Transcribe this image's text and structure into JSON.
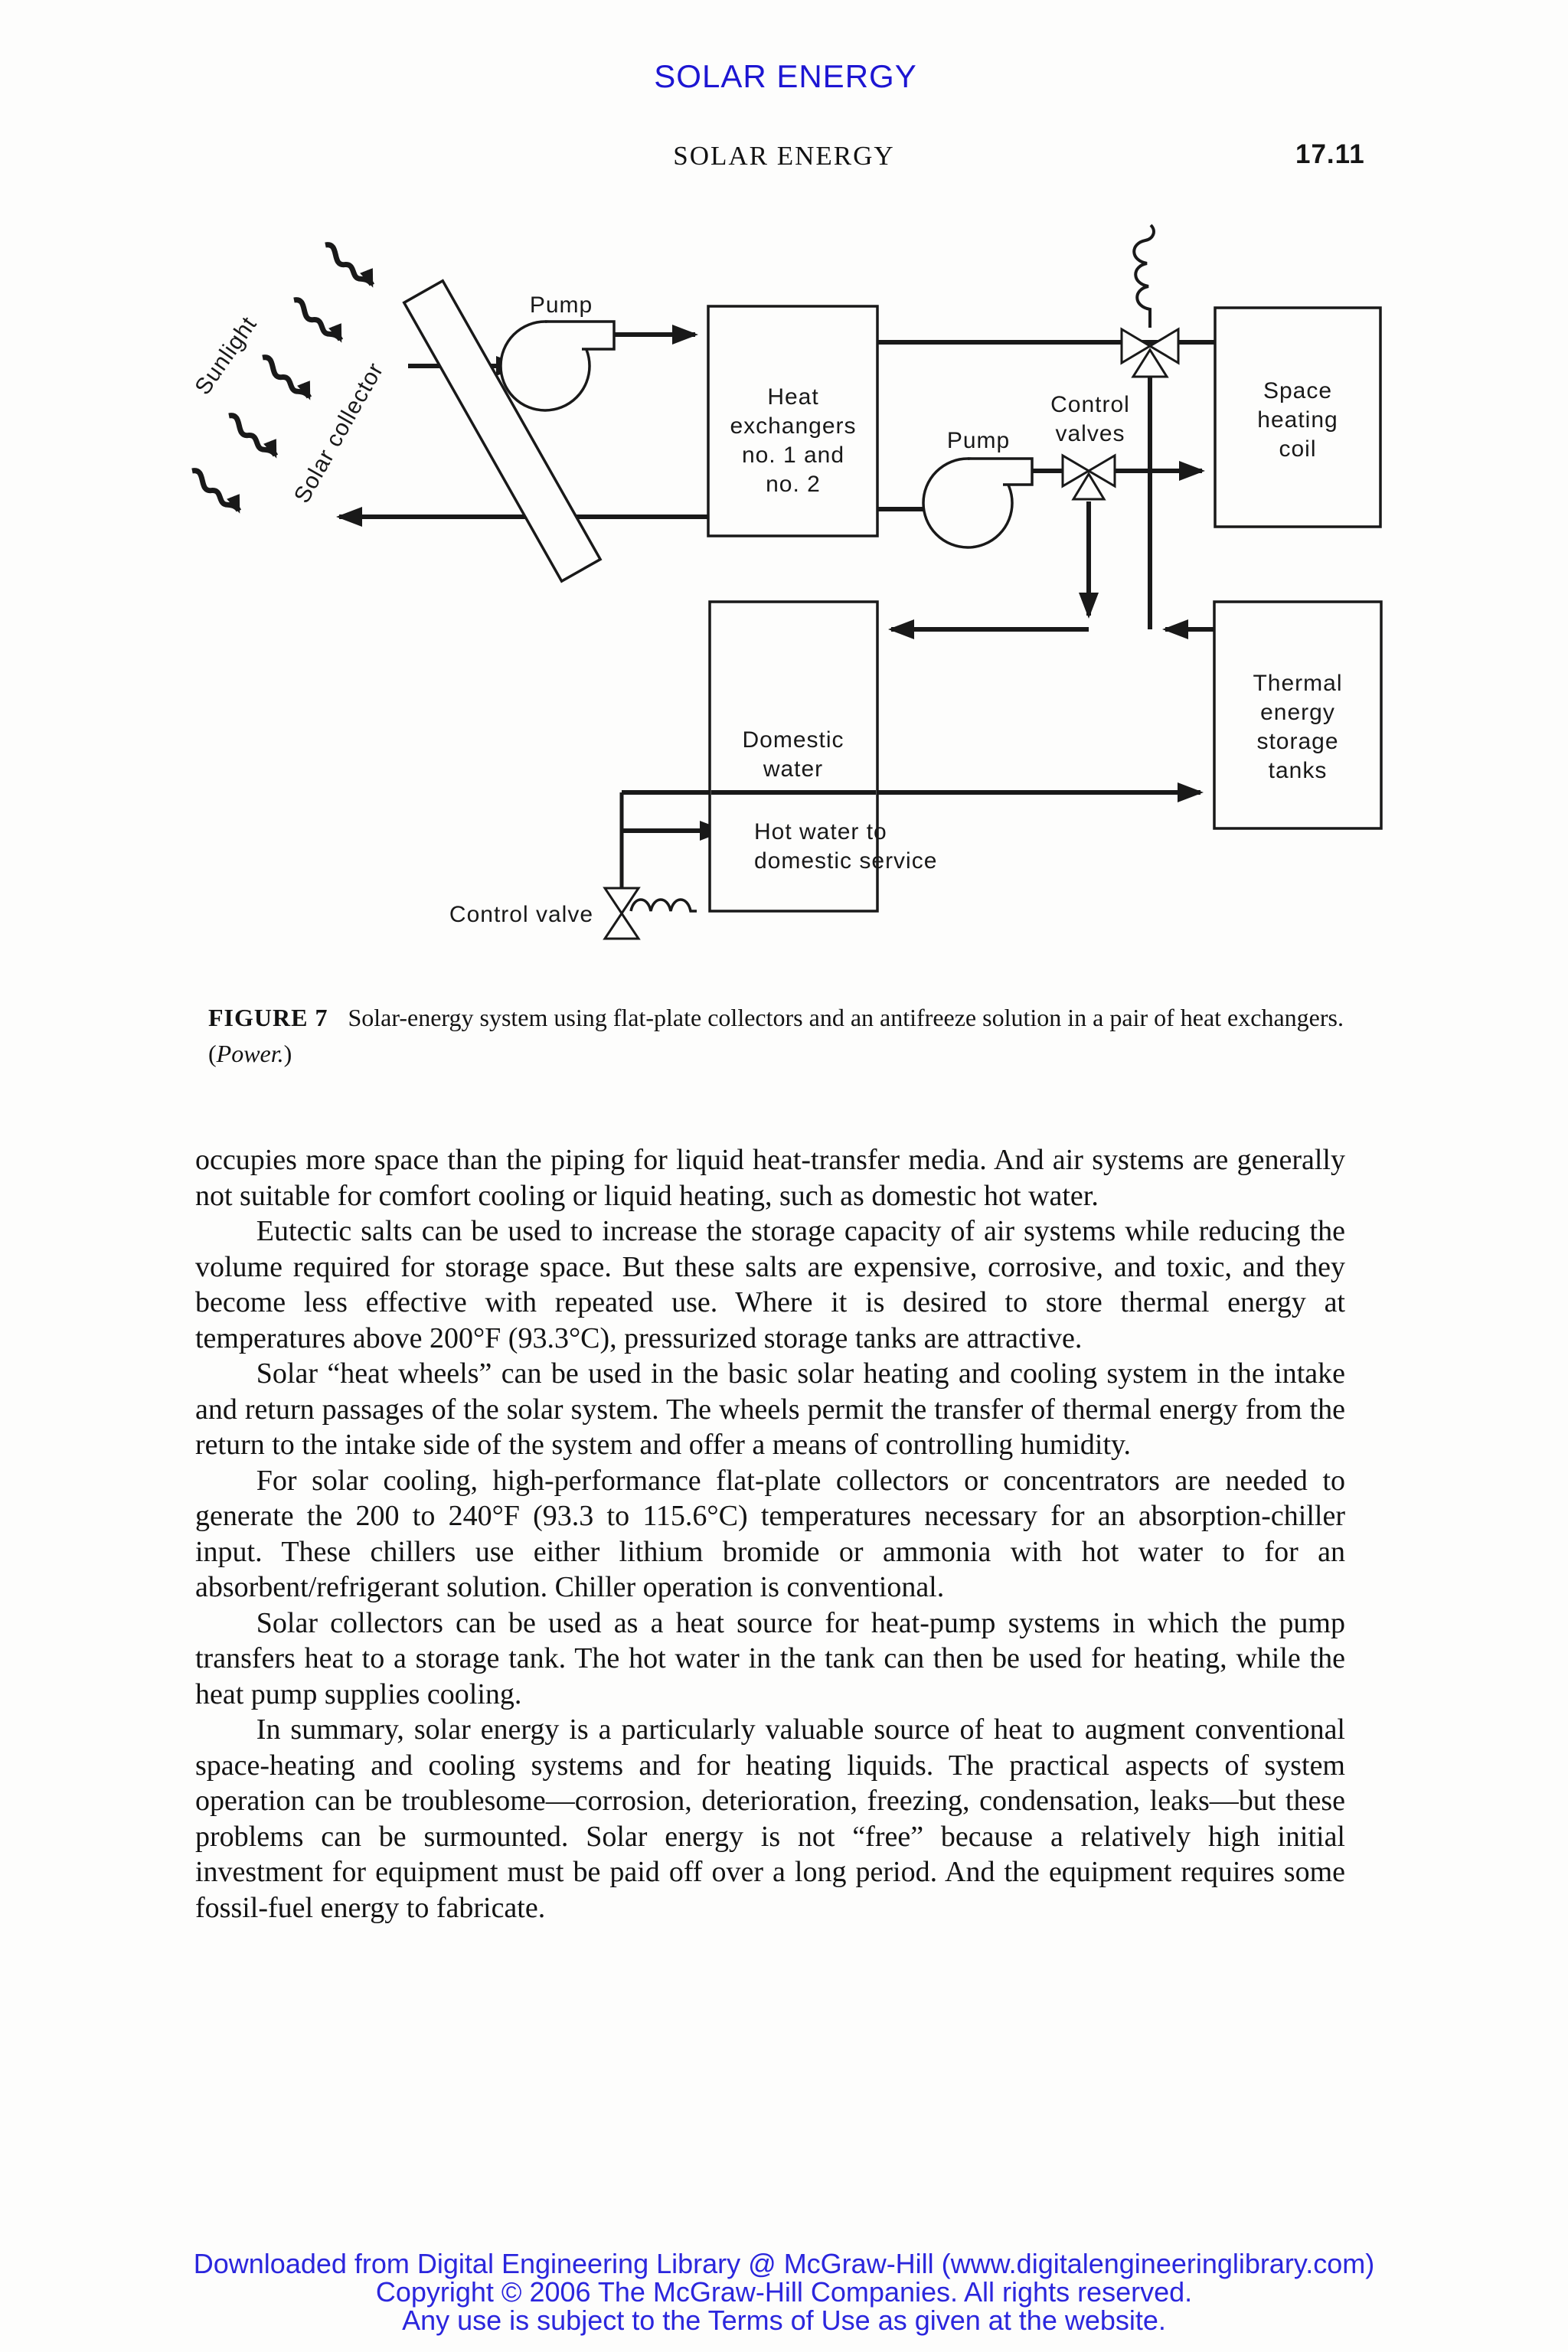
{
  "page": {
    "banner": "SOLAR ENERGY",
    "running_head": "SOLAR ENERGY",
    "page_number": "17.11",
    "colors": {
      "header_blue": "#1d16d2",
      "footer_blue": "#2b26dd",
      "ink": "#151515"
    },
    "figure": {
      "labels": {
        "sunlight": "Sunlight",
        "solar_collector": "Solar collector",
        "pump_top": "Pump",
        "pump_middle": "Pump",
        "control_valves_line1": "Control",
        "control_valves_line2": "valves",
        "heat_exchangers": [
          "Heat",
          "exchangers",
          "no. 1 and",
          "no. 2"
        ],
        "space_heating_coil": [
          "Space",
          "heating",
          "coil"
        ],
        "domestic_water": [
          "Domestic",
          "water"
        ],
        "thermal_storage": [
          "Thermal",
          "energy",
          "storage",
          "tanks"
        ],
        "hot_water_line1": "Hot water to",
        "hot_water_line2": "domestic service",
        "control_valve": "Control valve"
      },
      "caption": {
        "label": "FIGURE 7",
        "text": "Solar-energy system using flat-plate collectors and an antifreeze solution in a pair of heat exchangers. (",
        "source": "Power.",
        "suffix": ")"
      }
    },
    "body": {
      "paragraphs": [
        {
          "text": "occupies more space than the piping for liquid heat-transfer media. And air systems are generally not suitable for comfort cooling or liquid heating, such as domestic hot water."
        },
        {
          "text": "Eutectic salts can be used to increase the storage capacity of air systems while reducing the volume required for storage space. But these salts are expensive, corrosive, and toxic, and they become less effective with repeated use. Where it is desired to store thermal energy at temperatures above 200°F (93.3°C), pressurized storage tanks are attractive."
        },
        {
          "text": "Solar “heat wheels” can be used in the basic solar heating and cooling system in the intake and return passages of the solar system. The wheels permit the transfer of thermal energy from the return to the intake side of the system and offer a means of controlling humidity."
        },
        {
          "text": "For solar cooling, high-performance flat-plate collectors or concentrators are needed to generate the 200 to 240°F (93.3 to 115.6°C) temperatures necessary for an absorption-chiller input. These chillers use either lithium bromide or ammonia with hot water to for an absorbent/refrigerant solution. Chiller operation is conventional."
        },
        {
          "text": "Solar collectors can be used as a heat source for heat-pump systems in which the pump transfers heat to a storage tank. The hot water in the tank can then be used for heating, while the heat pump supplies cooling."
        },
        {
          "text": "In summary, solar energy is a particularly valuable source of heat to augment conventional space-heating and cooling systems and for heating liquids. The practical aspects of system operation can be troublesome—corrosion, deterioration, freezing, condensation, leaks—but these problems can be surmounted. Solar energy is not “free” because a relatively high initial investment for equipment must be paid off over a long period. And the equipment requires some fossil-fuel energy to fabricate."
        }
      ]
    },
    "footer": {
      "lines": [
        "Downloaded from Digital Engineering Library @ McGraw-Hill (www.digitalengineeringlibrary.com)",
        "Copyright © 2006 The McGraw-Hill Companies. All rights reserved.",
        "Any use is subject to the Terms of Use as given at the website."
      ]
    }
  }
}
